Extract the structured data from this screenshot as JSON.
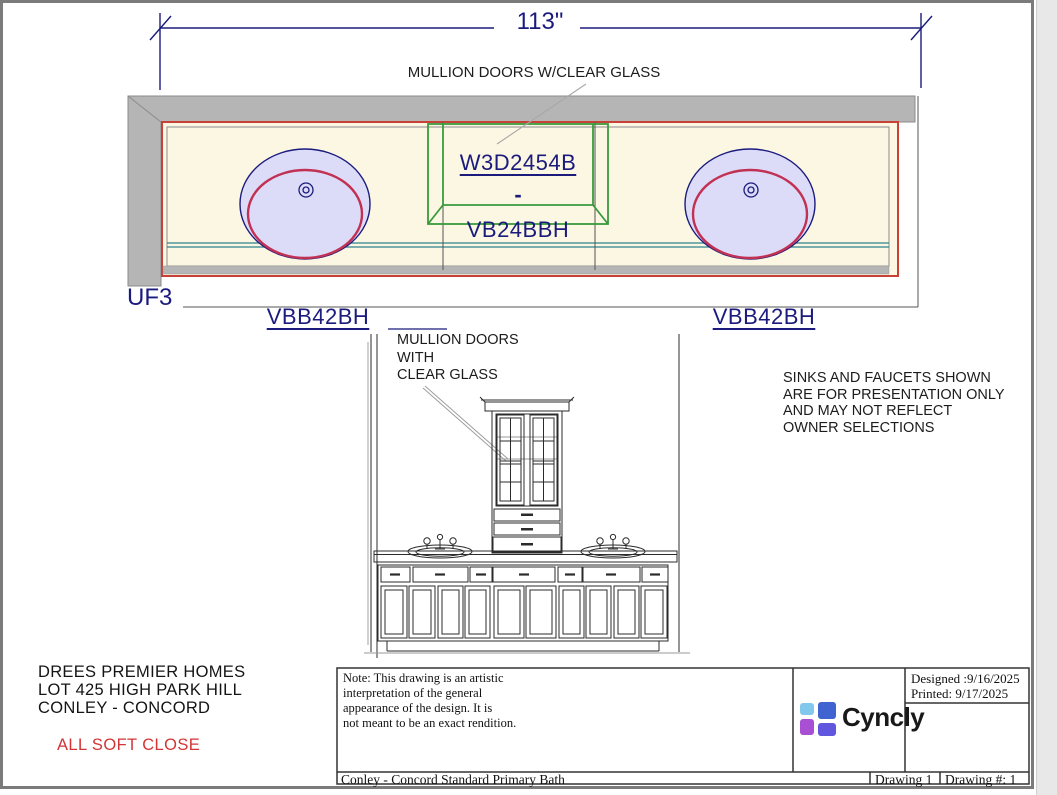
{
  "page": {
    "dimension_label": "113\"",
    "plan": {
      "mullion_note": "MULLION DOORS W/CLEAR GLASS",
      "wall_cabinet_code": "W3D2454B",
      "separator": "-",
      "base_cabinet_code": "VB24BBH",
      "filler_code": "UF3",
      "vanity_left_code": "VBB42BH",
      "vanity_right_code": "VBB42BH"
    },
    "elevation": {
      "mullion_note": "MULLION DOORS\nWITH\nCLEAR GLASS"
    },
    "presentation_note": "SINKS AND FAUCETS SHOWN\nARE FOR PRESENTATION ONLY\nAND MAY NOT REFLECT\nOWNER SELECTIONS",
    "project": {
      "line1": "DREES PREMIER HOMES",
      "line2": "LOT 425 HIGH PARK HILL",
      "line3": "CONLEY - CONCORD",
      "feature_note": "ALL SOFT CLOSE"
    },
    "title_block": {
      "note": "Note: This drawing is an artistic\ninterpretation of the general\nappearance of the design. It is\nnot meant to be an exact rendition.",
      "designed": "Designed :9/16/2025",
      "printed": "Printed: 9/17/2025",
      "brand": "Cyncly",
      "project_title": "Conley - Concord Standard Primary Bath",
      "drawing": "Drawing 1",
      "drawing_number": "Drawing #: 1"
    },
    "colors": {
      "navy": "#1b1b7e",
      "red": "#c94036",
      "green": "#389a3c",
      "teal": "#2e8290",
      "cream": "#fcf7e3",
      "wall": "#b5b5b5",
      "sink_fill": "#dcdcf8",
      "sink_red": "#c23153",
      "label_red": "#d23535"
    }
  }
}
